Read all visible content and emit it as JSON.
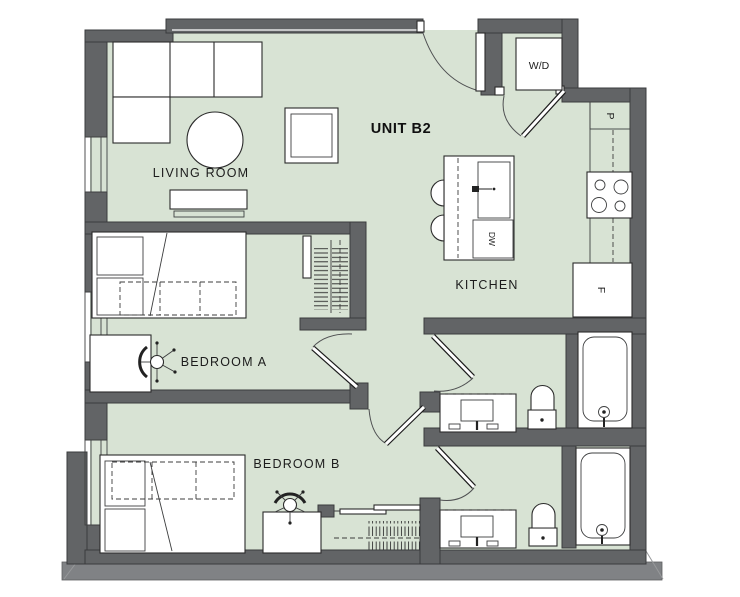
{
  "plan": {
    "unit_label": "UNIT B2",
    "rooms": {
      "living_room": "LIVING ROOM",
      "kitchen": "KITCHEN",
      "bedroom_a": "BEDROOM A",
      "bedroom_b": "BEDROOM B"
    },
    "appliances": {
      "washer_dryer": "W/D",
      "pantry": "P",
      "fridge": "F",
      "dishwasher": "DW"
    },
    "colors": {
      "canvas": "#ffffff",
      "floor_fill": "#d8e3d4",
      "wall_fill": "#626466",
      "wall_stroke": "#3a3b3d",
      "plinth_fill": "#808285",
      "fixture_fill": "#ffffff",
      "fixture_stroke": "#2b2b2b",
      "door_arc": "#4f5052",
      "label_color": "#1c1c1c"
    }
  }
}
